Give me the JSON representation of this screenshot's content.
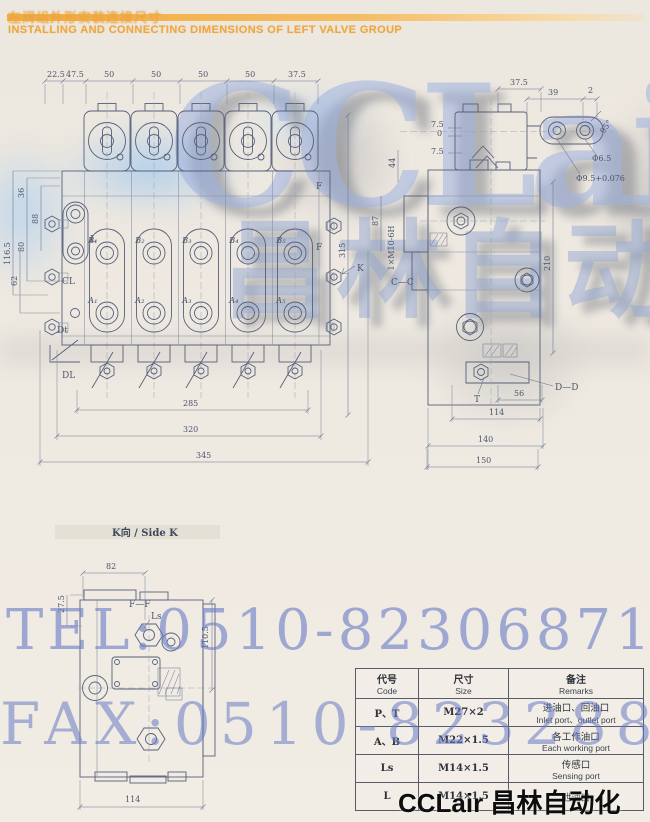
{
  "header": {
    "title_cn": "左阀组外形安装连接尺寸",
    "title_en": "INSTALLING AND CONNECTING DIMENSIONS OF LEFT VALVE GROUP"
  },
  "watermarks": {
    "brand_latin": "CCLair",
    "brand_cn": "昌林自动化",
    "tel": "TEL:0510-82306871",
    "fax": "FAX:0510-82328871",
    "brand_footer": "CCLair 昌林自动化"
  },
  "front_view": {
    "top_dims": [
      "22.5",
      "47.5",
      "50",
      "50",
      "50",
      "50",
      "37.5"
    ],
    "left_dims": {
      "d36": "36",
      "d88": "88",
      "d80": "80",
      "d116_5": "116.5",
      "d62": "62"
    },
    "bottom_dims": [
      "285",
      "320",
      "345"
    ],
    "height": "315",
    "ports_b": [
      "B₁",
      "B₂",
      "B₃",
      "B₄",
      "B₅"
    ],
    "ports_a": [
      "A₁",
      "A₂",
      "A₃",
      "A₄",
      "A₅"
    ],
    "labels": {
      "l": "L",
      "cl": "CL",
      "dt": "Dt",
      "dl": "DL",
      "f_top": "F",
      "f_mid": "F",
      "k": "K"
    }
  },
  "section_view": {
    "dims": {
      "w375": "37.5",
      "d39": "39",
      "d2": "2",
      "d75a": "7.5",
      "d0": "0",
      "d75b": "7.5",
      "d44": "44",
      "d87": "87",
      "d210": "210",
      "d56": "56",
      "d114": "114",
      "d140": "140",
      "d150": "150"
    },
    "labels": {
      "angle": "95°",
      "dia_small": "Φ6.5",
      "dia_large": "Φ9.5+0.076",
      "thread": "1×M10-6H",
      "section_cc": "C—C",
      "section_dd": "D—D",
      "t": "T"
    }
  },
  "side_k": {
    "title": "K向 / Side K",
    "dims": {
      "d82": "82",
      "d275": "27.5",
      "d1105": "110.5",
      "d114": "114"
    },
    "labels": {
      "ff": "F—F",
      "ls": "Ls"
    }
  },
  "table": {
    "headers": [
      {
        "cn": "代号",
        "en": "Code"
      },
      {
        "cn": "尺寸",
        "en": "Size"
      },
      {
        "cn": "备注",
        "en": "Remarks"
      }
    ],
    "rows": [
      {
        "code": "P、T",
        "size": "M27×2",
        "remark_cn": "进油口、回油口",
        "remark_en": "Inlet port、outlet port"
      },
      {
        "code": "A、B",
        "size": "M22×1.5",
        "remark_cn": "各工作油口",
        "remark_en": "Each working port"
      },
      {
        "code": "Ls",
        "size": "M14×1.5",
        "remark_cn": "传感口",
        "remark_en": "Sensing port"
      },
      {
        "code": "L",
        "size": "M14×1.5",
        "remark_cn": "泄油口",
        "remark_en": ""
      }
    ]
  },
  "colors": {
    "accent_orange": "#efa63e",
    "watermark_blue": "#7d93c8",
    "line": "#57607a",
    "footer_black": "#0d0d0d"
  }
}
